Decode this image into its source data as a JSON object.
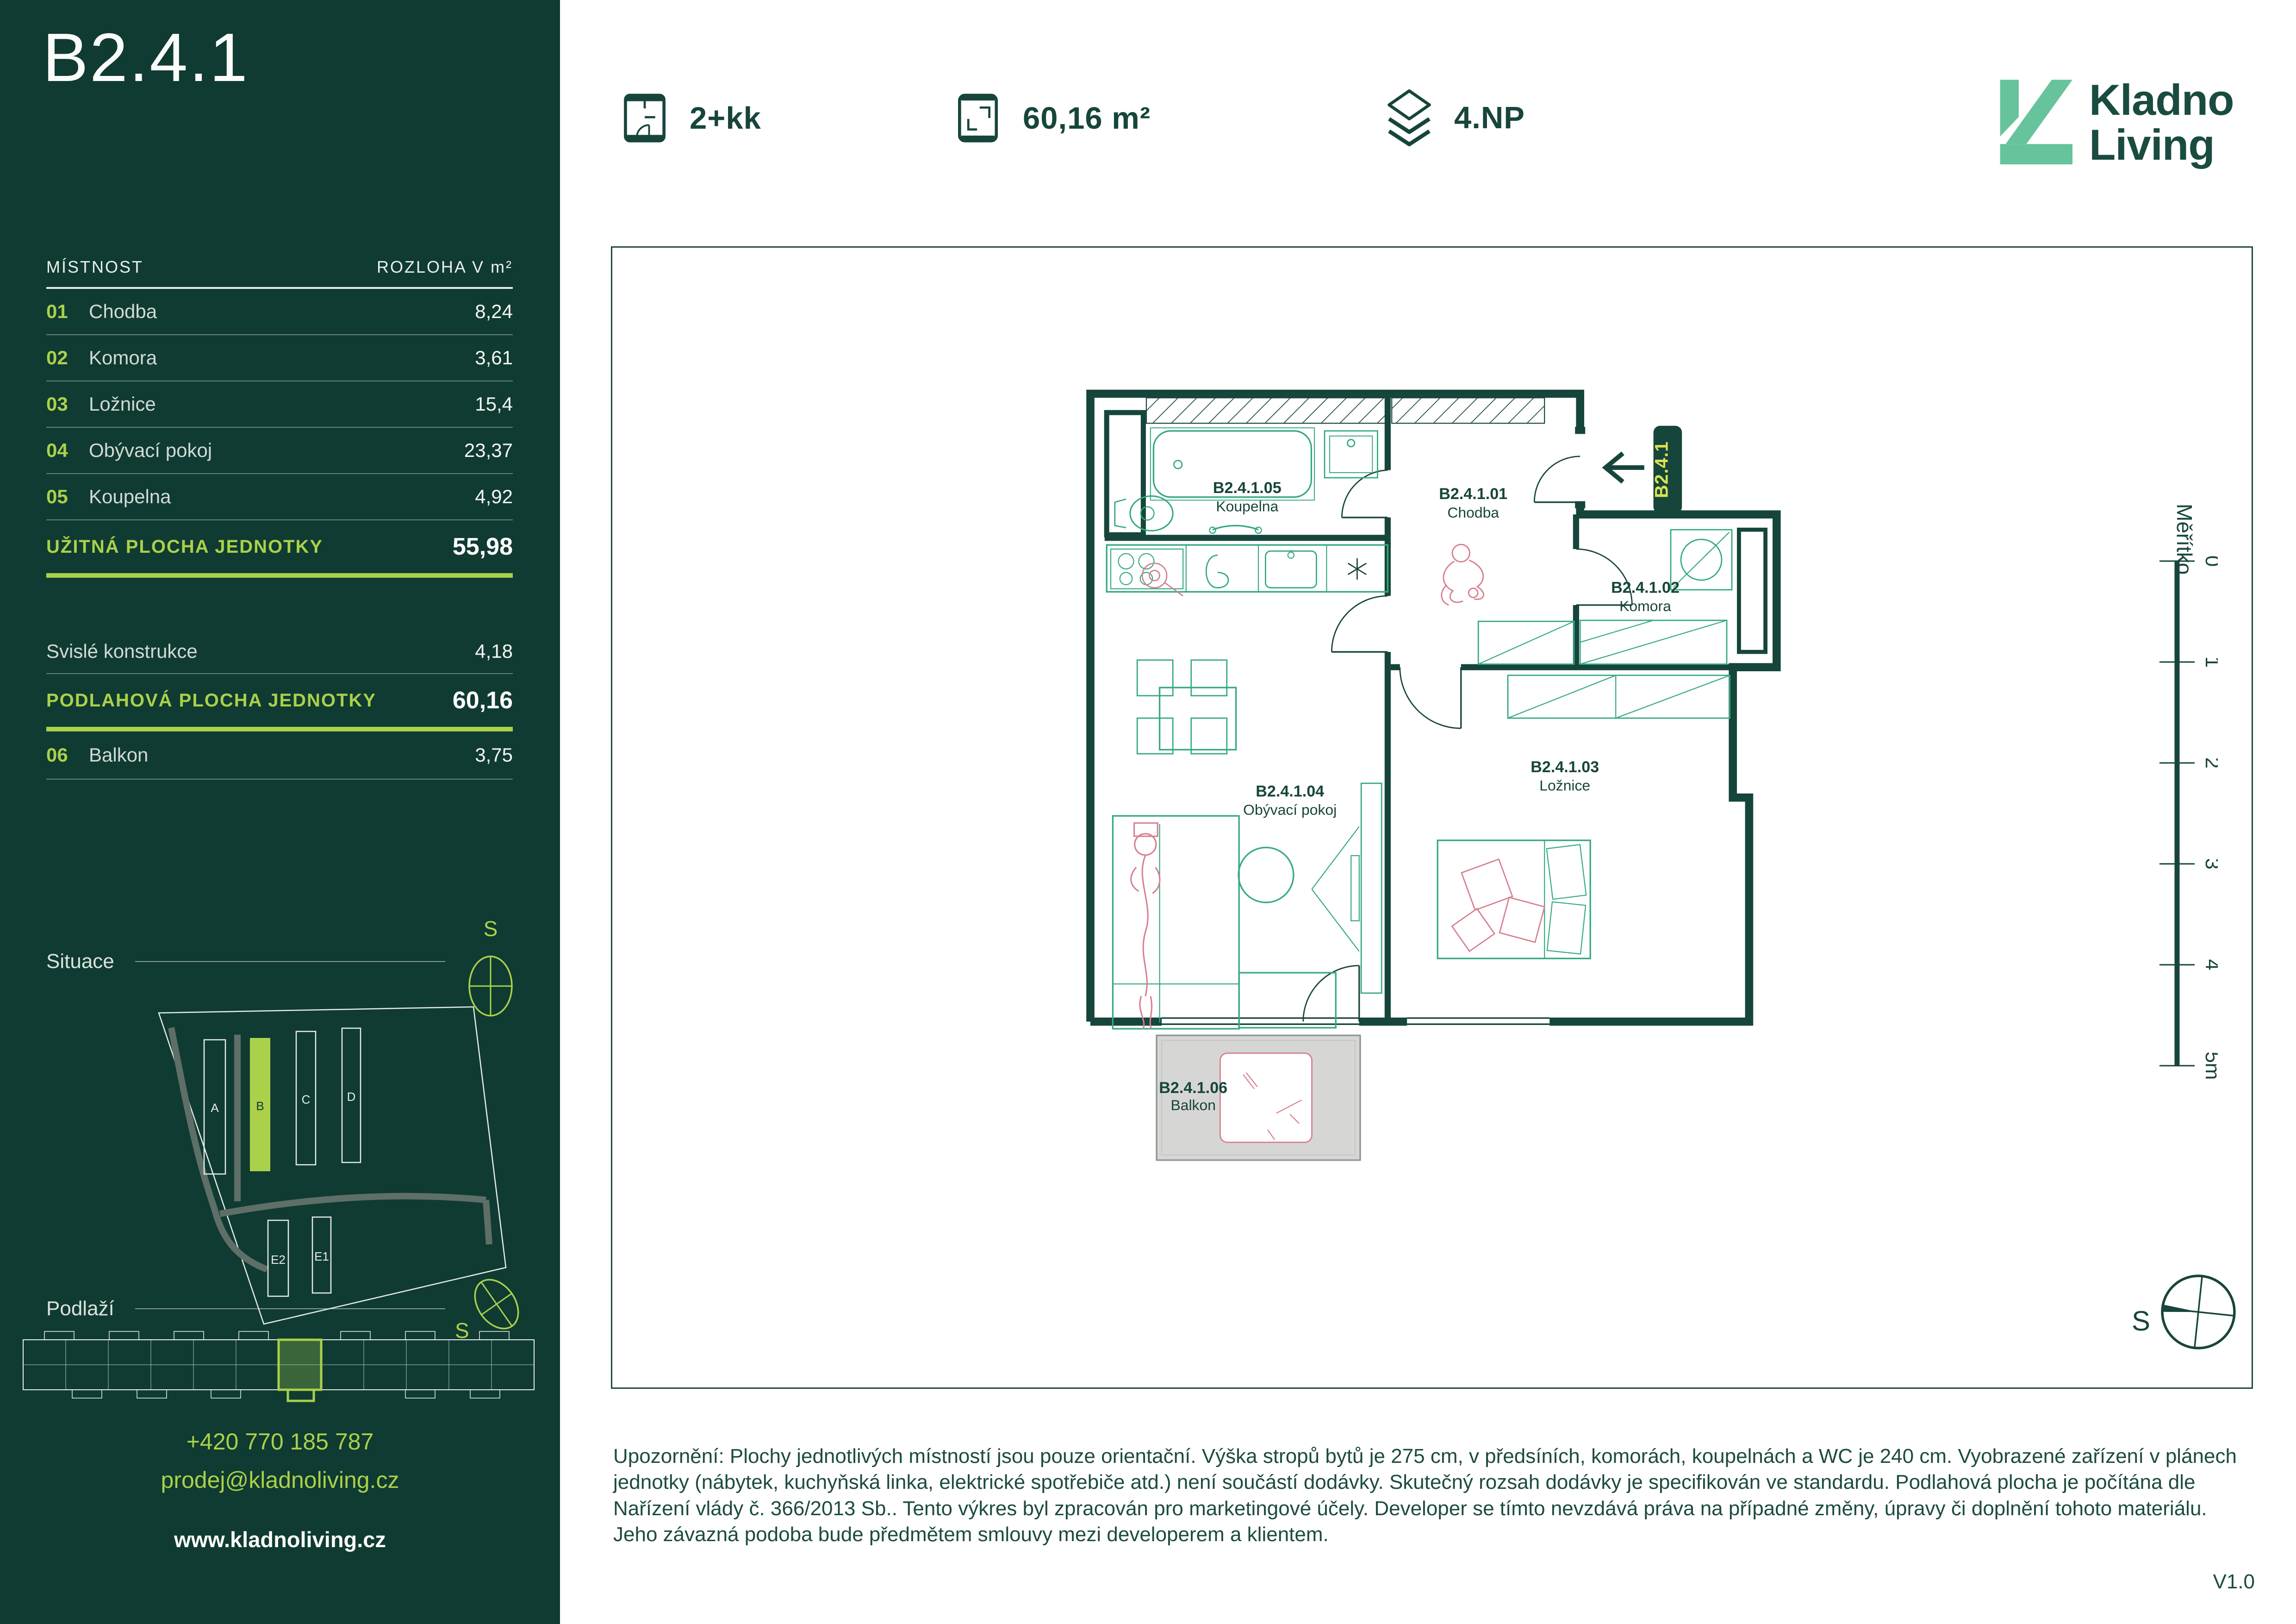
{
  "colors": {
    "sidebar_bg": "#0F3B32",
    "lime": "#ABD04A",
    "badge_text": "#DCE34F",
    "dark_green": "#17453C",
    "furniture_green": "#35A97F",
    "accent_pink": "#D77F8E",
    "balcony_fill": "#D6D6D4",
    "logo_mint": "#66C39B"
  },
  "sidebar": {
    "title": "B2.4.1",
    "table": {
      "header": {
        "room": "MÍSTNOST",
        "area": "ROZLOHA V m²"
      },
      "rows": [
        {
          "num": "01",
          "name": "Chodba",
          "value": "8,24"
        },
        {
          "num": "02",
          "name": "Komora",
          "value": "3,61"
        },
        {
          "num": "03",
          "name": "Ložnice",
          "value": "15,4"
        },
        {
          "num": "04",
          "name": "Obývací pokoj",
          "value": "23,37"
        },
        {
          "num": "05",
          "name": "Koupelna",
          "value": "4,92"
        }
      ],
      "usable": {
        "label": "UŽITNÁ PLOCHA JEDNOTKY",
        "value": "55,98"
      },
      "construction": {
        "label": "Svislé konstrukce",
        "value": "4,18"
      },
      "floor_total": {
        "label": "PODLAHOVÁ PLOCHA JEDNOTKY",
        "value": "60,16"
      },
      "balcony": {
        "num": "06",
        "name": "Balkon",
        "value": "3,75"
      }
    },
    "situace": {
      "label": "Situace",
      "compass": "S",
      "buildings": {
        "a": "A",
        "b": "B",
        "c": "C",
        "d": "D",
        "e2": "E2",
        "e1": "E1"
      }
    },
    "podlazi": {
      "label": "Podlaží",
      "compass": "S"
    },
    "contact": {
      "phone": "+420 770 185 787",
      "email": "prodej@kladnoliving.cz",
      "web": "www.kladnoliving.cz"
    }
  },
  "header": {
    "disposition": "2+kk",
    "area": "60,16 m²",
    "floor": "4.NP",
    "logo": {
      "line1": "Kladno",
      "line2": "Living"
    }
  },
  "plan": {
    "entrance_badge": "B2.4.1",
    "rooms": {
      "koupelna": {
        "code": "B2.4.1.05",
        "name": "Koupelna"
      },
      "chodba": {
        "code": "B2.4.1.01",
        "name": "Chodba"
      },
      "komora": {
        "code": "B2.4.1.02",
        "name": "Komora"
      },
      "loznice": {
        "code": "B2.4.1.03",
        "name": "Ložnice"
      },
      "obyvaci": {
        "code": "B2.4.1.04",
        "name": "Obývací pokoj"
      },
      "balkon": {
        "code": "B2.4.1.06",
        "name": "Balkon"
      }
    },
    "scale": {
      "label": "Měřítko",
      "ticks": [
        "0",
        "1",
        "2",
        "3",
        "4",
        "5m"
      ]
    },
    "compass": "S"
  },
  "footer": {
    "disclaimer": "Upozornění: Plochy jednotlivých místností jsou pouze orientační. Výška stropů bytů je 275 cm, v předsíních, komorách, koupelnách a WC je 240 cm. Vyobrazené zařízení v plánech jednotky (nábytek, kuchyňská linka, elektrické spotřebiče atd.) není součástí dodávky. Skutečný rozsah dodávky je specifikován ve standardu. Podlahová plocha je počítána dle Nařízení vlády č. 366/2013 Sb.. Tento výkres byl zpracován pro marketingové účely. Developer se tímto nevzdává práva na případné změny, úpravy či doplnění tohoto materiálu. Jeho závazná podoba bude předmětem smlouvy mezi developerem a klientem.",
    "version": "V1.0"
  }
}
